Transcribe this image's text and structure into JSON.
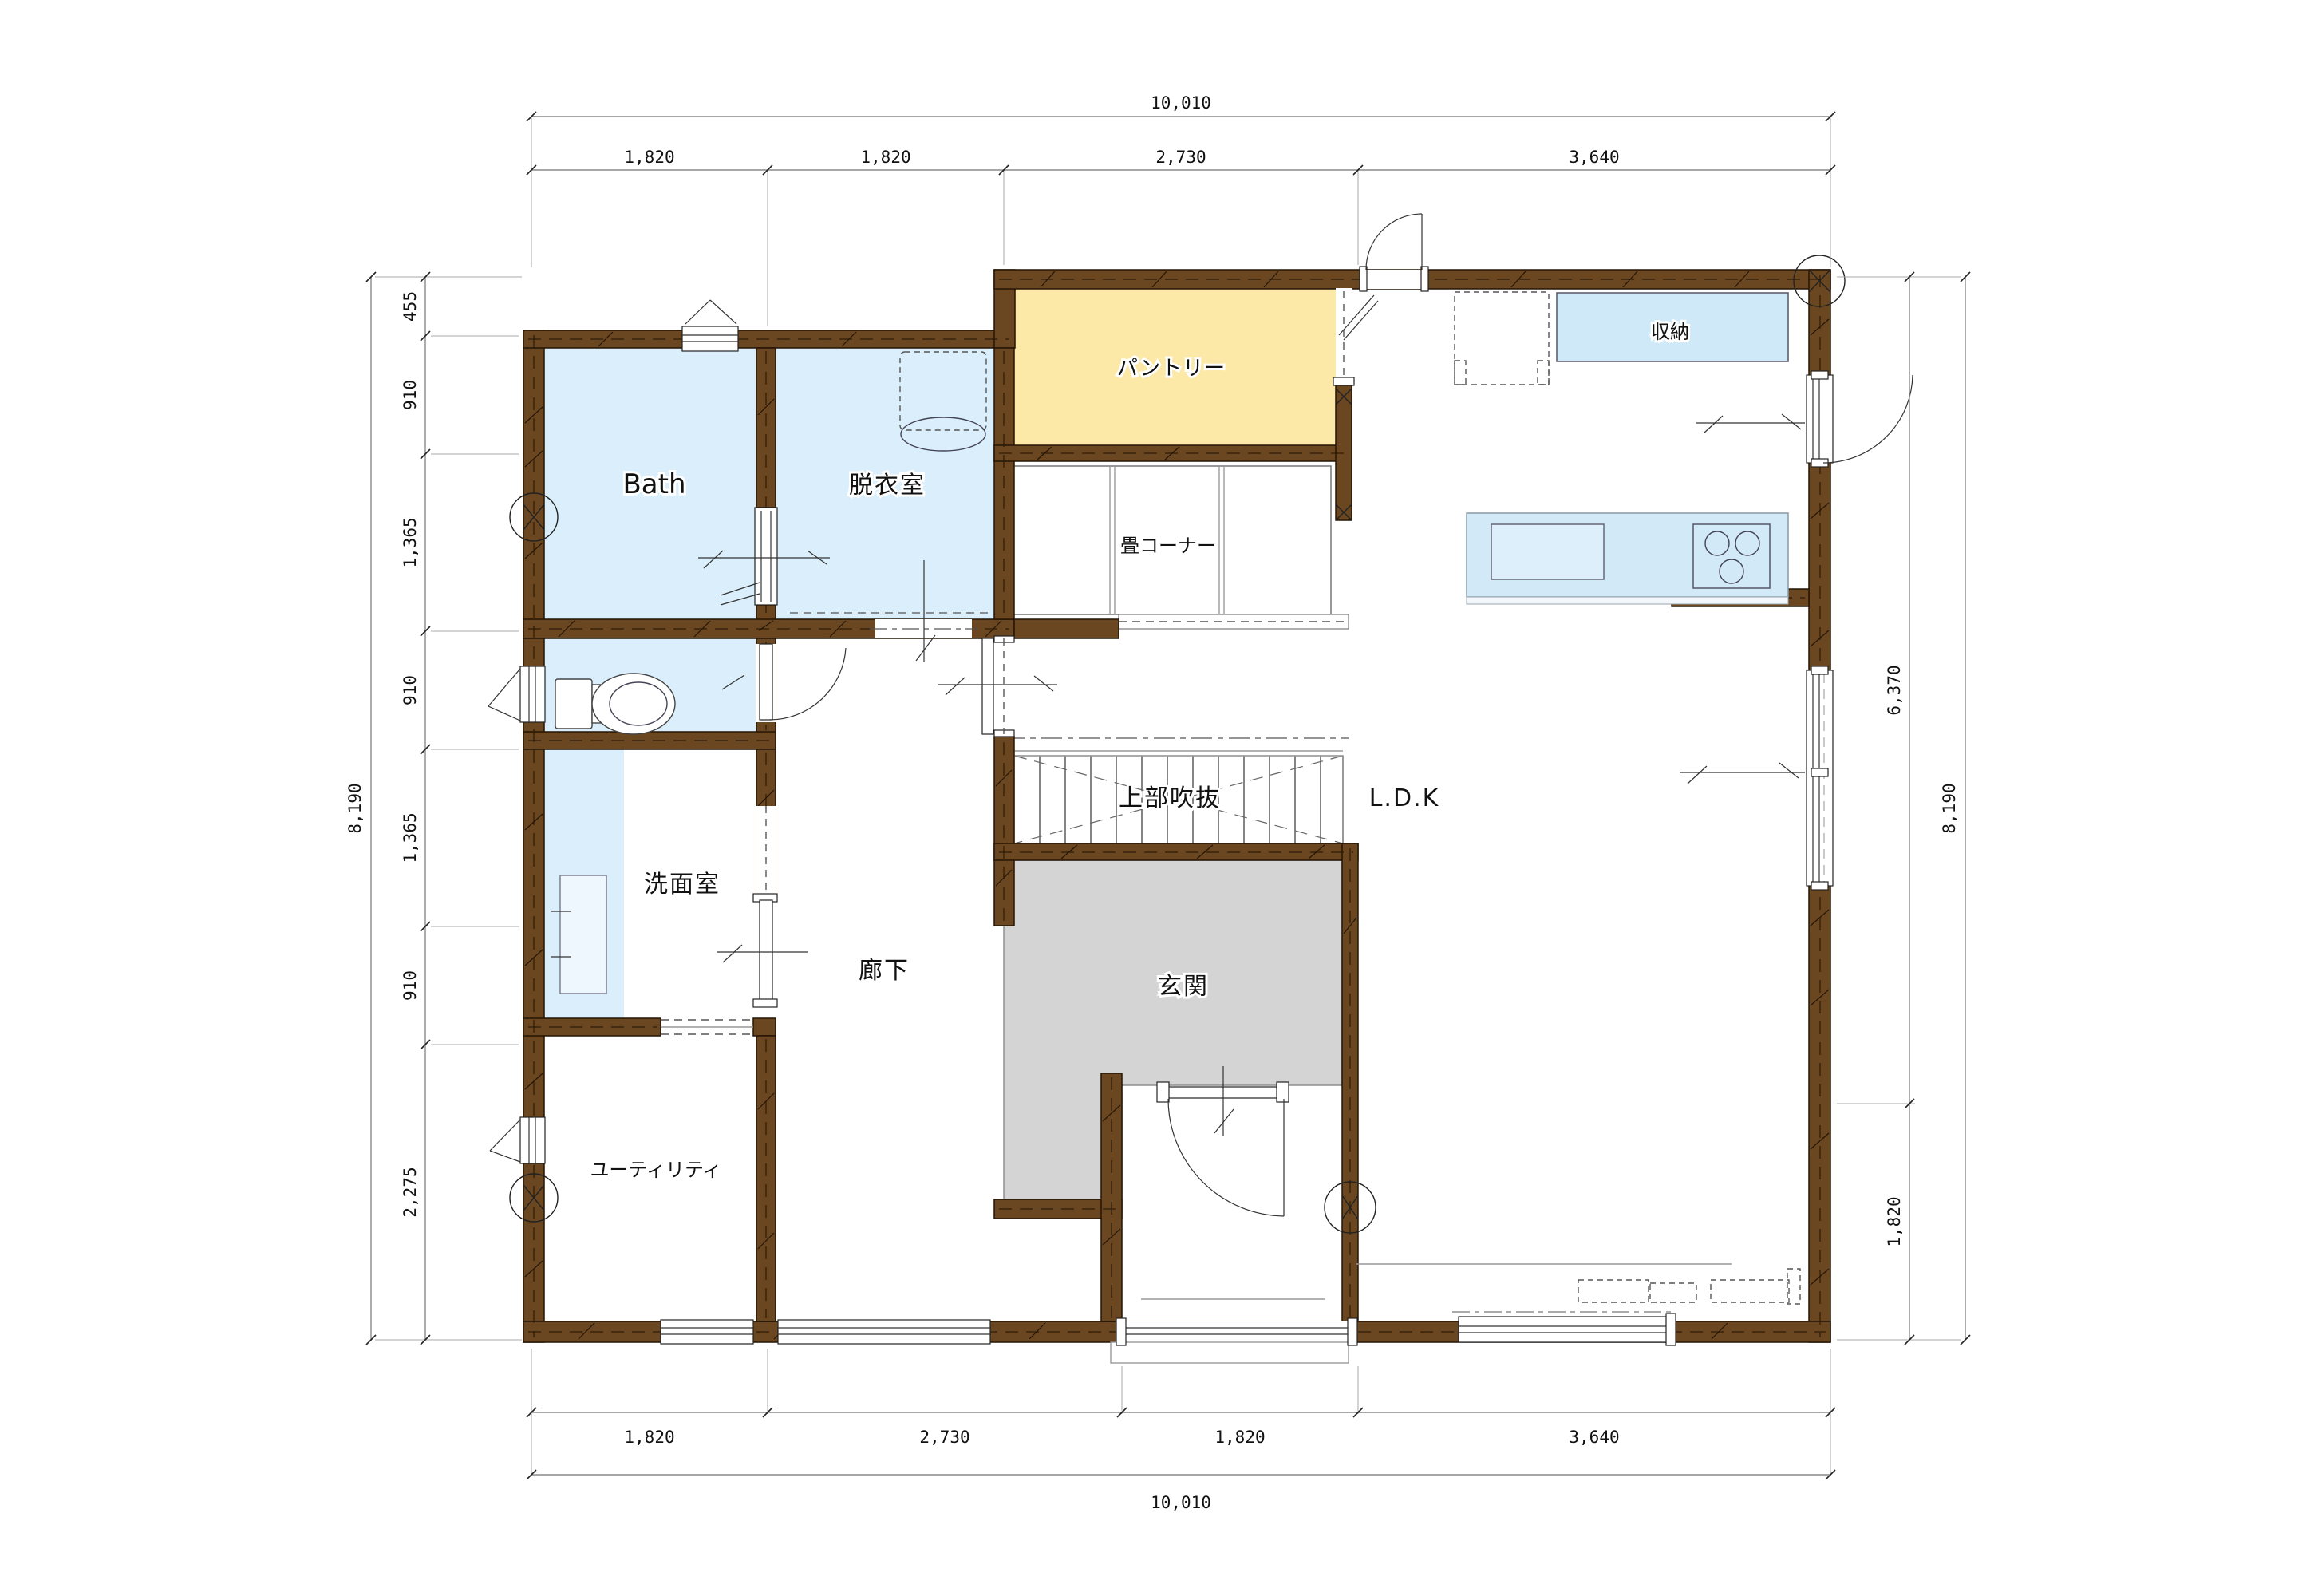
{
  "rooms": {
    "bath": "Bath",
    "dressing_room": "脱衣室",
    "pantry": "パントリー",
    "tatami_corner": "畳コーナー",
    "storage": "収納",
    "ldk": "L.D.K",
    "upper_void": "上部吹抜",
    "entrance": "玄関",
    "corridor": "廊下",
    "washroom": "洗面室",
    "utility": "ユーティリティ"
  },
  "dimensions": {
    "top": {
      "total": "10,010",
      "segments": [
        "1,820",
        "1,820",
        "2,730",
        "3,640"
      ]
    },
    "bottom": {
      "total": "10,010",
      "segments": [
        "1,820",
        "2,730",
        "1,820",
        "3,640"
      ]
    },
    "left": {
      "total": "8,190",
      "segments": [
        "455",
        "910",
        "1,365",
        "910",
        "1,365",
        "910",
        "2,275"
      ]
    },
    "right": {
      "total": "8,190",
      "segments": [
        "6,370",
        "1,820"
      ]
    }
  },
  "colors": {
    "wall": "#6a4720",
    "water_room": "#daeefb",
    "pantry_fill": "#fce9a7",
    "entrance_gray": "#d4d4d4",
    "counter_blue": "#d2eaf8",
    "storage_blue": "#cfe9f8"
  }
}
